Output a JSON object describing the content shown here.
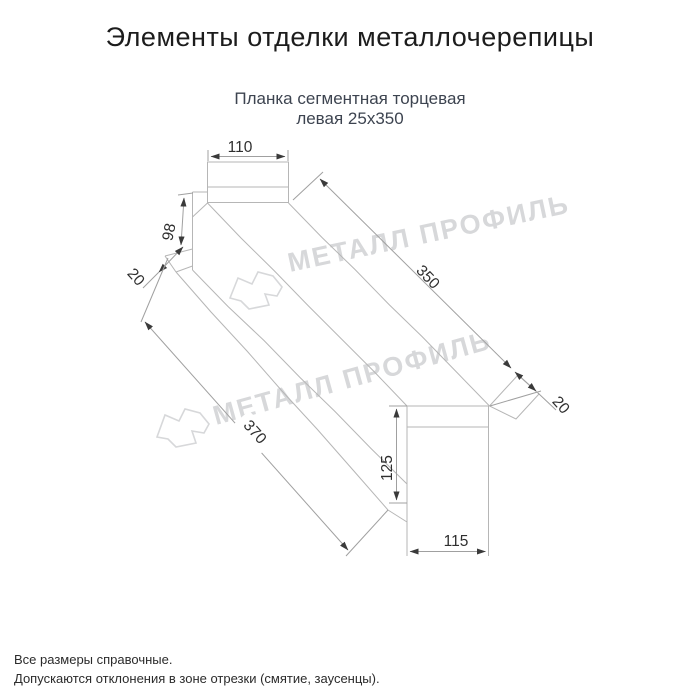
{
  "page": {
    "title": "Элементы отделки металлочерепицы",
    "subtitle_line1": "Планка сегментная торцевая",
    "subtitle_line2": "левая 25х350"
  },
  "drawing": {
    "dim_top_width": "110",
    "dim_left_height": "98",
    "dim_left_flange": "20",
    "dim_length_top": "350",
    "dim_right_flange": "20",
    "dim_length_bottom": "370",
    "dim_end_height": "125",
    "dim_end_width": "115"
  },
  "watermark": {
    "text": "МЕТАЛЛ ПРОФИЛЬ"
  },
  "footer": {
    "note1": "Все размеры справочные.",
    "note2": "Допускаются отклонения в зоне отрезки (смятие, заусенцы)."
  },
  "colors": {
    "outline": "#b6b6b6",
    "dimension": "#a0a0a0",
    "arrow": "#3a3a3a",
    "watermark": "#d7d8da",
    "subtitle": "#3d4450"
  }
}
